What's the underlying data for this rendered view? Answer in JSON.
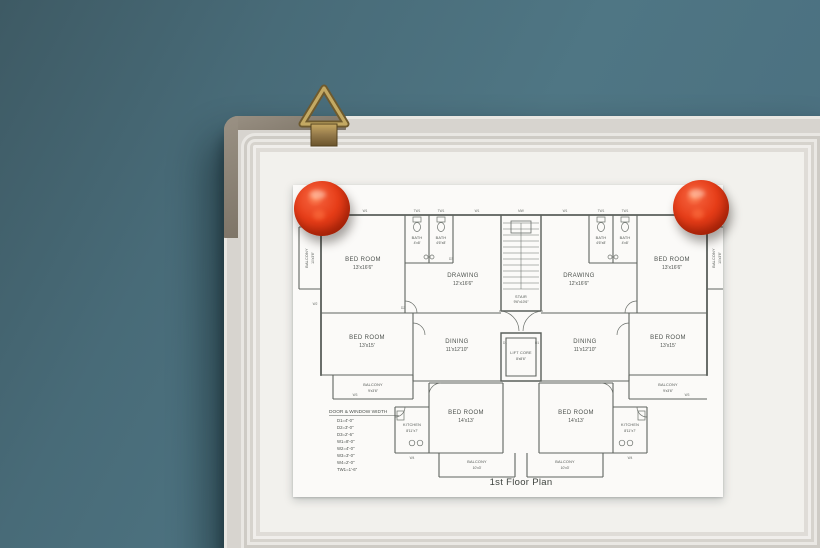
{
  "scene": {
    "wall_color": "#4a6d7a",
    "board_color": "#f2f1ed",
    "corner_cap_color": "#8c8378",
    "magnet_color": "#e63d18",
    "hanger_color": "#b2975a",
    "paper_color": "#fbfaf8",
    "ink_color": "#565b57"
  },
  "plan": {
    "title": "1st Floor Plan",
    "rooms": {
      "bedroom_top": {
        "name": "BED ROOM",
        "dims": "13'x16'6\""
      },
      "bath_a": {
        "name": "BATH",
        "dims": "4'x8'"
      },
      "bath_b": {
        "name": "BATH",
        "dims": "4'6\"x8'"
      },
      "drawing": {
        "name": "DRAWING",
        "dims": "12'x16'6\""
      },
      "stair": {
        "name": "STAIR",
        "dims": "9'6\"x10'6\""
      },
      "lift": {
        "name": "LIFT CORE",
        "dims": "8'x8'6\""
      },
      "dining": {
        "name": "DINING",
        "dims": "11'x12'10\""
      },
      "bedroom_mid": {
        "name": "BED ROOM",
        "dims": "13'x15'"
      },
      "balcony_mid": {
        "name": "BALCONY",
        "dims": "9'x3'6\""
      },
      "kitchen": {
        "name": "KITCHEN",
        "dims": "8'11\"x7'"
      },
      "bedroom_bottom": {
        "name": "BED ROOM",
        "dims": "14'x13'"
      },
      "balcony_bottom": {
        "name": "BALCONY",
        "dims": "10'x3'"
      },
      "balcony_side": {
        "name": "BALCONY",
        "dims": "10'x3'6\""
      }
    },
    "legend": {
      "title": "DOOR & WINDOW WIDTH",
      "items": [
        "D1=4'-0\"",
        "D2=3'-0\"",
        "D3=2'-6\"",
        "W1=8'-0\"",
        "W2=4'-0\"",
        "W3=3'-0\"",
        "W4=2'-0\"",
        "TW1=1'-6\""
      ]
    },
    "wall_labels": [
      "W1",
      "TW1",
      "TW1",
      "W1",
      "MW",
      "W1",
      "TW1",
      "TW1",
      "W1",
      "W2",
      "W3",
      "W3",
      "W4",
      "W4",
      "D1",
      "D1",
      "D2",
      "D3"
    ]
  }
}
